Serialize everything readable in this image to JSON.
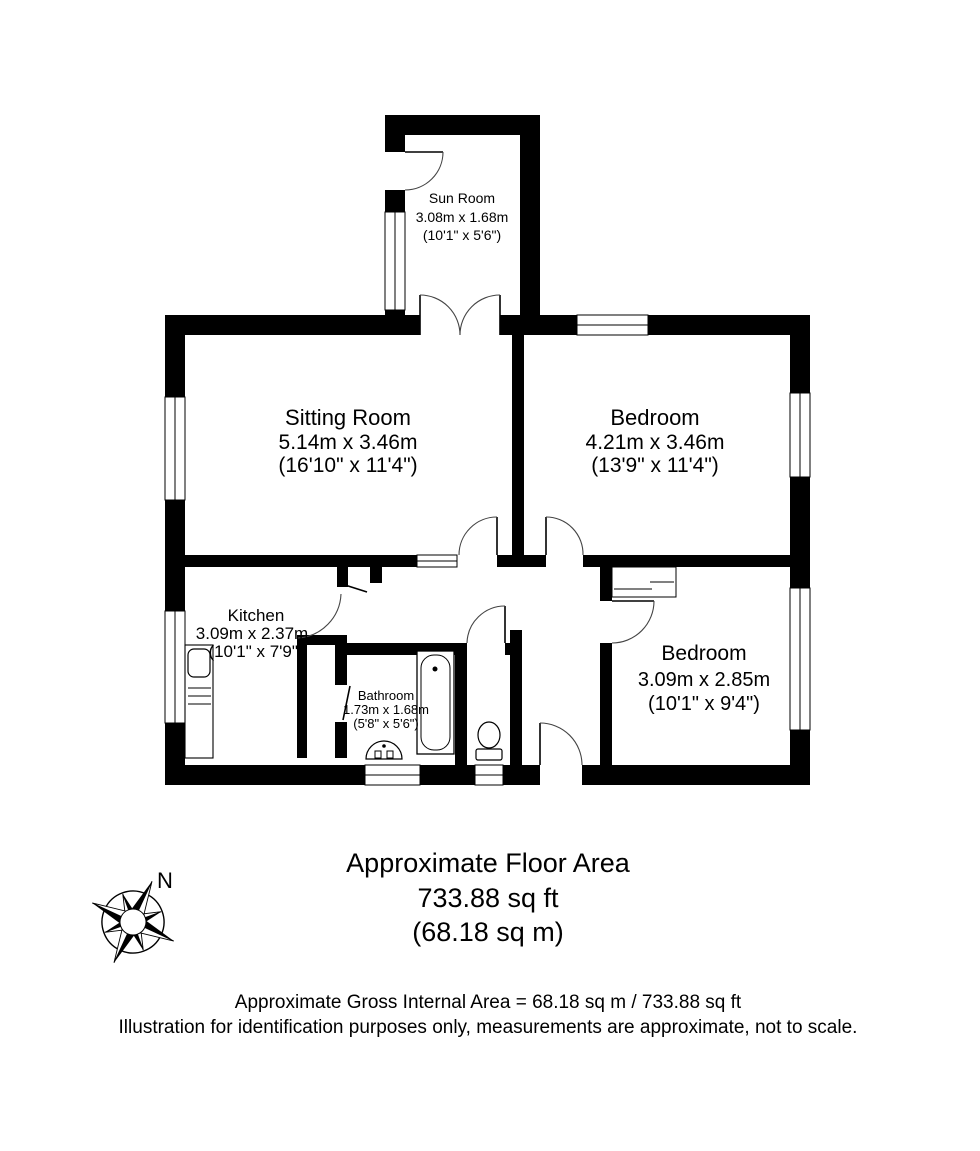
{
  "plan": {
    "rooms": [
      {
        "name": "Sun Room",
        "metric": "3.08m x 1.68m",
        "imperial": "(10'1\" x 5'6\")"
      },
      {
        "name": "Sitting Room",
        "metric": "5.14m x 3.46m",
        "imperial": "(16'10\" x 11'4\")"
      },
      {
        "name": "Bedroom",
        "metric": "4.21m x 3.46m",
        "imperial": "(13'9\" x 11'4\")"
      },
      {
        "name": "Kitchen",
        "metric": "3.09m x 2.37m",
        "imperial": "(10'1\" x 7'9\")"
      },
      {
        "name": "Bathroom",
        "metric": "1.73m x 1.68m",
        "imperial": "(5'8\" x 5'6\")"
      },
      {
        "name": "Bedroom",
        "metric": "3.09m x 2.85m",
        "imperial": "(10'1\" x 9'4\")"
      }
    ],
    "compass_label": "N"
  },
  "area_summary": {
    "line1": "Approximate Floor Area",
    "line2": "733.88 sq ft",
    "line3": "(68.18 sq m)"
  },
  "footer": {
    "line1": "Approximate Gross Internal Area = 68.18 sq m / 733.88 sq ft",
    "line2": "Illustration for identification purposes only, measurements are approximate, not to scale."
  },
  "colors": {
    "wall": "#000000",
    "background": "#ffffff",
    "door_arc": "#444444"
  }
}
